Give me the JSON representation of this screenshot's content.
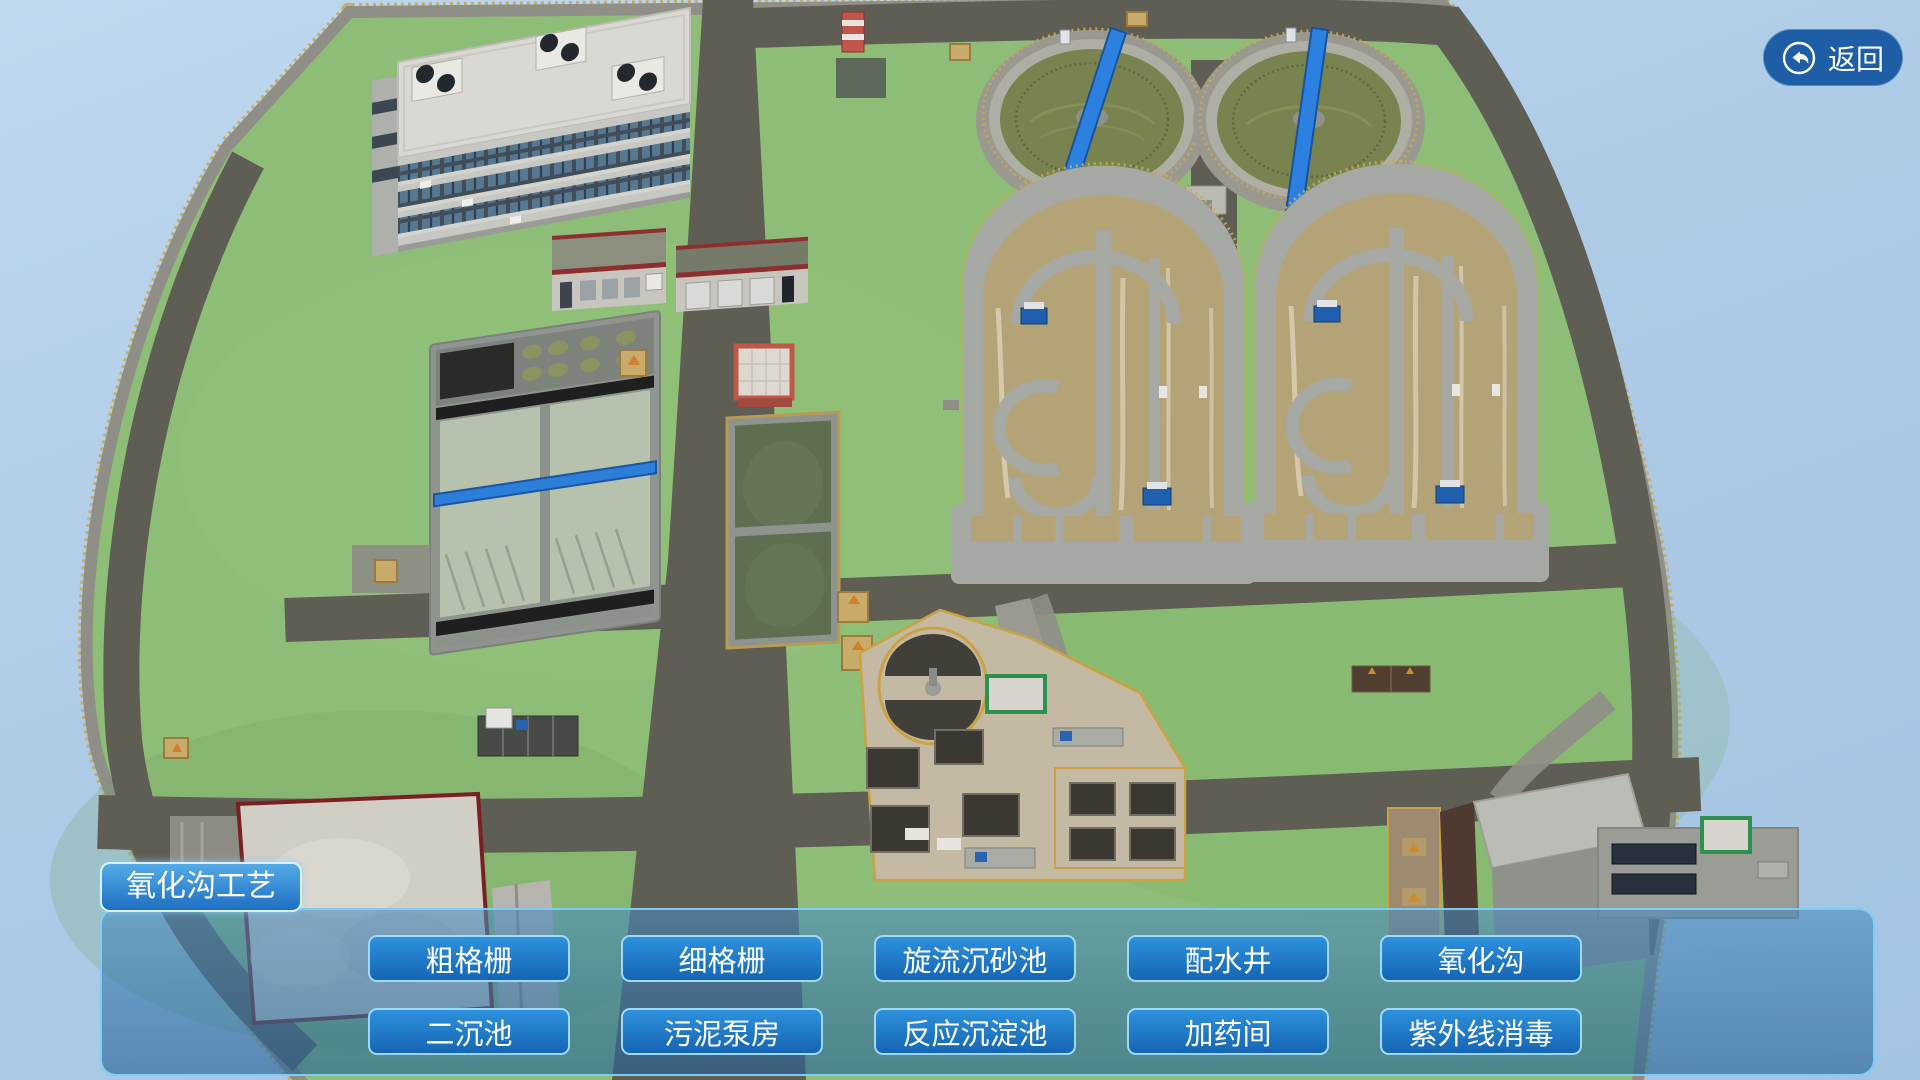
{
  "app": {
    "process_title": "氧化沟工艺"
  },
  "toolbar": {
    "back_label": "返回",
    "back_icon": "return-arrow-in-circle"
  },
  "panel": {
    "row1": [
      {
        "label": "粗格栅"
      },
      {
        "label": "细格栅"
      },
      {
        "label": "旋流沉砂池"
      },
      {
        "label": "配水井"
      },
      {
        "label": "氧化沟"
      }
    ],
    "row2": [
      {
        "label": "二沉池"
      },
      {
        "label": "污泥泵房"
      },
      {
        "label": "反应沉淀池"
      },
      {
        "label": "加药间"
      },
      {
        "label": "紫外线消毒"
      }
    ]
  },
  "colors": {
    "sky": "#aecbe6",
    "grass": "#8dbd76",
    "road": "#5f5e55",
    "fence": "#c9a85a",
    "concrete": "#a6a8a3",
    "ditch_water": "#b3a377",
    "clarifier_water": "#79834f",
    "pond_water": "#5d6f4f",
    "bridge_blue": "#2b80e0",
    "panel_fill": "#3e83b8",
    "panel_border": "#7fd0f5",
    "button_fill": "#1f79c8",
    "button_border": "#9ed9f7",
    "back_button": "#1e5ea6",
    "red_trim": "#8d2f2f"
  }
}
